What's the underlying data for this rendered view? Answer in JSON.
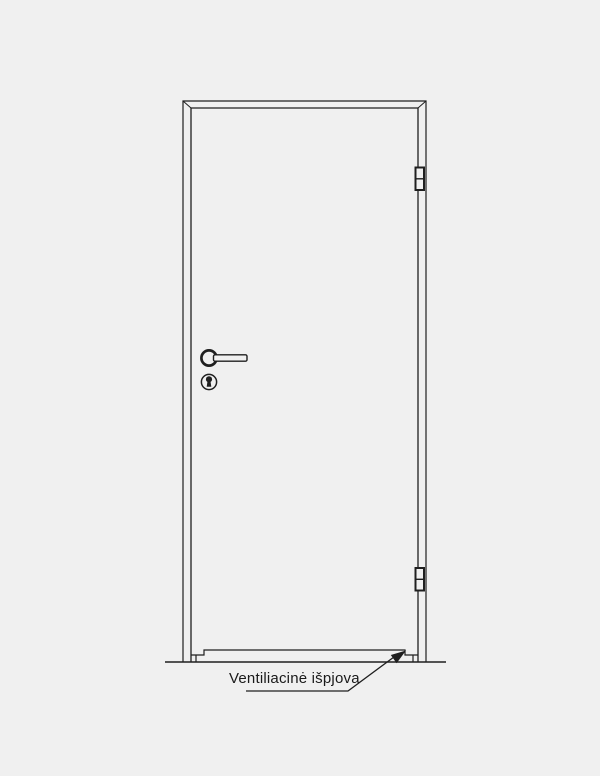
{
  "page": {
    "background_color": "#f0f0f0"
  },
  "drawing": {
    "line_color": "#1f1f1f",
    "text_color": "#1a1a1a",
    "components": [
      "door-frame",
      "door-leaf",
      "hinge-top-icon",
      "hinge-bottom-icon",
      "lever-handle-icon",
      "keyhole-icon",
      "ventilation-cutout",
      "floor-line",
      "leader-arrow"
    ],
    "annotation": {
      "text": "Ventiliacinė išpjova"
    }
  }
}
